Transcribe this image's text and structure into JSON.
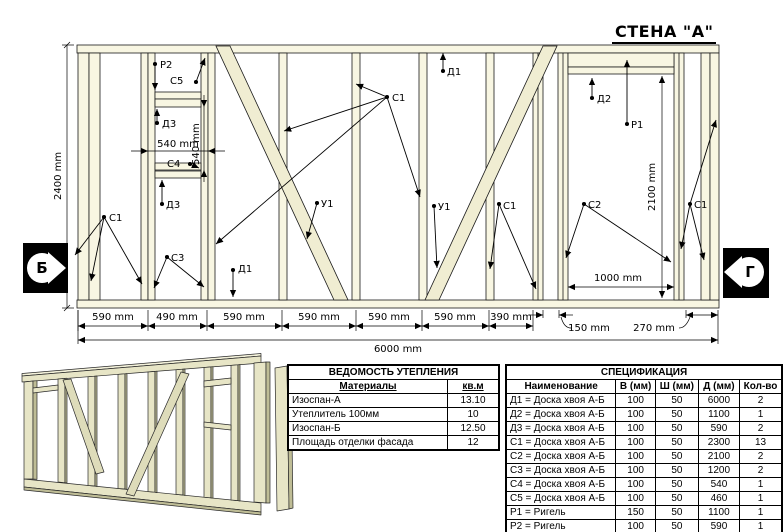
{
  "title": "СТЕНА \"А\"",
  "section_markers": {
    "left": "Б",
    "right": "Г"
  },
  "colors": {
    "wood_fill": "#F8F6E2",
    "wood_diag": "#F0EDD2",
    "wood_shade": "#BFBD96",
    "line_color": "#000000",
    "badge_bg": "#000000"
  },
  "drawing": {
    "dim_height": "2400 mm",
    "dim_total": "6000 mm",
    "dim_door_height": "2100 mm",
    "dim_door_width": "1000 mm",
    "dim_window_width": "540 mm",
    "dim_window_height": "540 mm",
    "bottom_dims": [
      "590 mm",
      "490 mm",
      "590 mm",
      "590 mm",
      "590 mm",
      "590 mm",
      "390 mm",
      "150 mm",
      "270 mm"
    ],
    "annotations": [
      "Р2",
      "С5",
      "Д3",
      "С4",
      "Д3",
      "С1",
      "С3",
      "Д1",
      "У1",
      "С1",
      "Д1",
      "У1",
      "С1",
      "С2",
      "Д2",
      "Р1",
      "С1"
    ]
  },
  "insulation_table": {
    "title": "ВЕДОМОСТЬ УТЕПЛЕНИЯ",
    "headers": [
      "Материалы",
      "кв.м"
    ],
    "rows": [
      [
        "Изоспан-А",
        "13.10"
      ],
      [
        "Утеплитель 100мм",
        "10"
      ],
      [
        "Изоспан-Б",
        "12.50"
      ],
      [
        "Площадь отделки фасада",
        "12"
      ]
    ]
  },
  "spec_table": {
    "title": "СПЕЦИФИКАЦИЯ",
    "headers": [
      "Наименование",
      "В (мм)",
      "Ш (мм)",
      "Д (мм)",
      "Кол-во"
    ],
    "rows": [
      [
        "Д1 = Доска хвоя А-Б",
        "100",
        "50",
        "6000",
        "2"
      ],
      [
        "Д2 = Доска хвоя А-Б",
        "100",
        "50",
        "1100",
        "1"
      ],
      [
        "Д3 = Доска хвоя А-Б",
        "100",
        "50",
        "590",
        "2"
      ],
      [
        "С1 = Доска хвоя А-Б",
        "100",
        "50",
        "2300",
        "13"
      ],
      [
        "С2 = Доска хвоя А-Б",
        "100",
        "50",
        "2100",
        "2"
      ],
      [
        "С3 = Доска хвоя А-Б",
        "100",
        "50",
        "1200",
        "2"
      ],
      [
        "С4 = Доска хвоя А-Б",
        "100",
        "50",
        "540",
        "1"
      ],
      [
        "С5 = Доска хвоя А-Б",
        "100",
        "50",
        "460",
        "1"
      ],
      [
        "Р1 = Ригель",
        "150",
        "50",
        "1100",
        "1"
      ],
      [
        "Р2 = Ригель",
        "100",
        "50",
        "590",
        "1"
      ],
      [
        "У = Укосина хвоя А-Б",
        "100",
        "25",
        "2670",
        "2"
      ]
    ]
  }
}
